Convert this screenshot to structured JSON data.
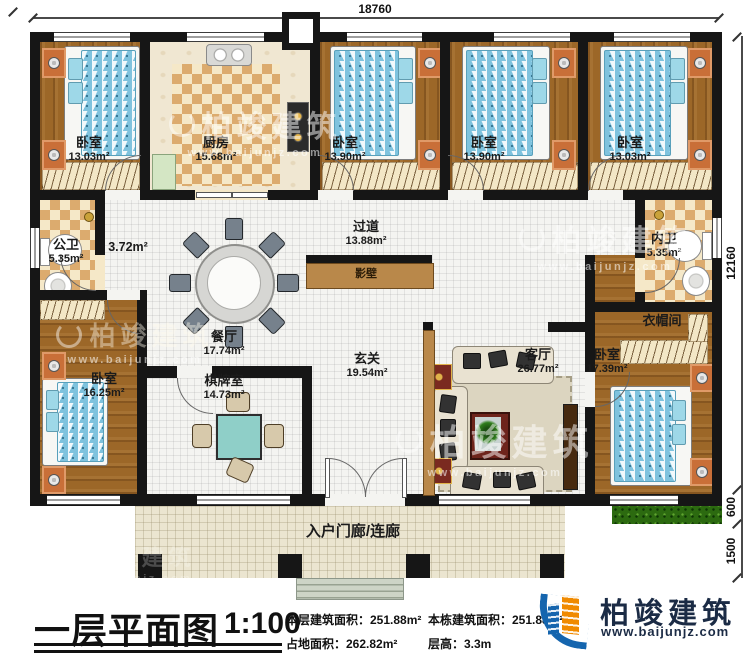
{
  "plan": {
    "dims": {
      "width_top": "18760",
      "height_main": "12160",
      "height_grass": "600",
      "height_porch": "1500"
    },
    "rooms": [
      {
        "id": "bedroom-top-left",
        "name": "卧室",
        "area": "13.03m²"
      },
      {
        "id": "kitchen",
        "name": "厨房",
        "area": "15.68m²"
      },
      {
        "id": "bedroom-top-2",
        "name": "卧室",
        "area": "13.90m²"
      },
      {
        "id": "bedroom-top-3",
        "name": "卧室",
        "area": "13.90m²"
      },
      {
        "id": "bedroom-top-right",
        "name": "卧室",
        "area": "13.03m²"
      },
      {
        "id": "public-bathroom",
        "name": "公卫",
        "area": "5.35m²"
      },
      {
        "id": "side-hall",
        "name": "",
        "area": "3.72m²"
      },
      {
        "id": "corridor",
        "name": "过道",
        "area": "13.88m²"
      },
      {
        "id": "screen-wall",
        "name": "影壁",
        "area": ""
      },
      {
        "id": "dining-room",
        "name": "餐厅",
        "area": "17.74m²"
      },
      {
        "id": "inner-bathroom",
        "name": "内卫",
        "area": "5.35m²"
      },
      {
        "id": "cloakroom",
        "name": "衣帽间",
        "area": ""
      },
      {
        "id": "bedroom-bottom-left",
        "name": "卧室",
        "area": "16.25m²"
      },
      {
        "id": "chess-room",
        "name": "棋牌室",
        "area": "14.73m²"
      },
      {
        "id": "foyer",
        "name": "玄关",
        "area": "19.54m²"
      },
      {
        "id": "living-room",
        "name": "客厅",
        "area": "26.77m²"
      },
      {
        "id": "bedroom-bottom-right",
        "name": "卧室",
        "area": "17.39m²"
      },
      {
        "id": "entry-porch",
        "name": "入户门廊/连廊",
        "area": ""
      }
    ]
  },
  "title_block": {
    "title": "一层平面图",
    "scale": "1:100",
    "stats": [
      "本层建筑面积：251.88m²",
      "占地面积：262.82m²",
      "本栋建筑面积：251.88m²",
      "层高：3.3m"
    ]
  },
  "logo": {
    "company": "柏竣建筑",
    "website": "www.baijunjz.com"
  },
  "watermark": {
    "brand": "柏竣建筑",
    "website": "www.baijunjz.com"
  },
  "colors": {
    "wall": "#161616",
    "wood_floor": "#9c6728",
    "tile": "#dcab6e",
    "bed_blue": "#7fc3de",
    "grass_green": "#2c6a10",
    "screen_wall_brown": "#b9884a",
    "logo_blue": "#1565ae",
    "logo_orange": "#f08a00",
    "logo_text": "#1b2b45"
  }
}
